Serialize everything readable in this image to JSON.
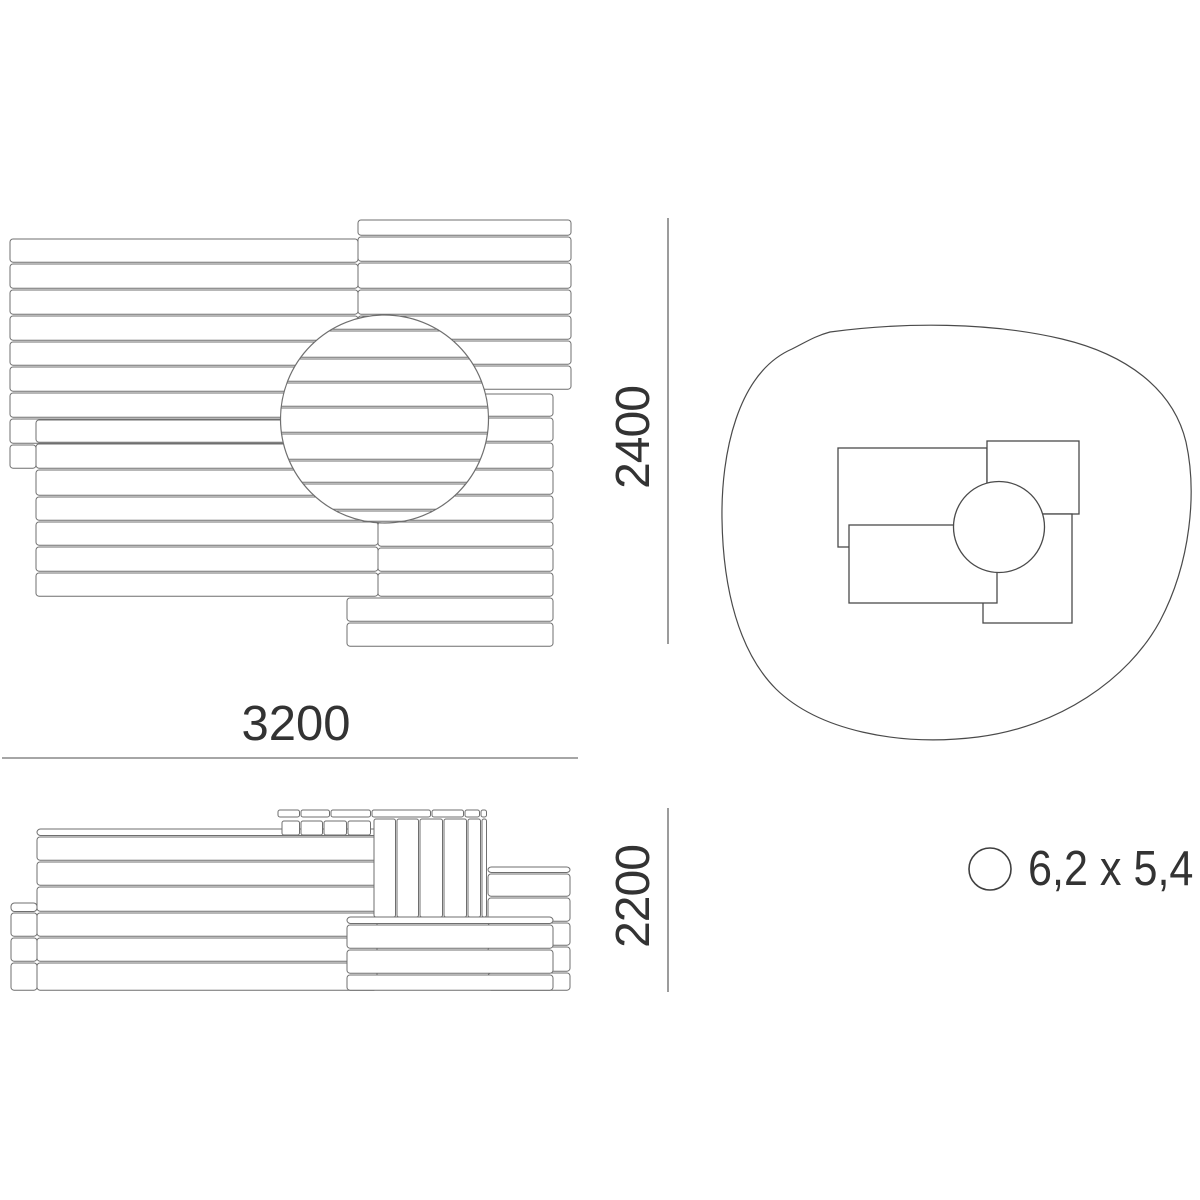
{
  "page": {
    "background": "#ffffff",
    "board_line_color": "#6f6f6f",
    "dim_line_color": "#4c4c4c",
    "text_color": "#333333"
  },
  "dimensions": {
    "plan_width": "3200",
    "plan_depth": "2400",
    "elevation_height": "2200"
  },
  "safety_zone": {
    "size_label": "6,2 x 5,4"
  }
}
